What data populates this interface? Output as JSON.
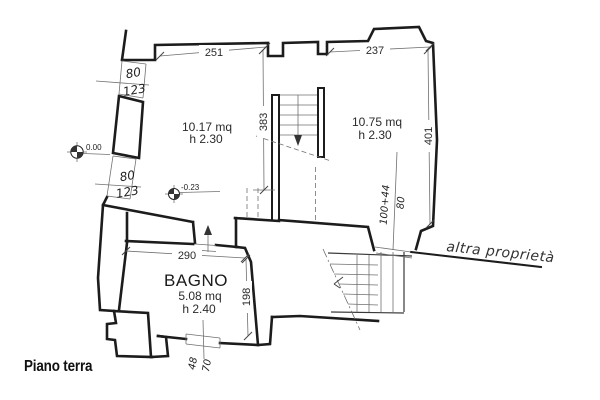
{
  "colors": {
    "ink": "#1c1c1c",
    "thin": "#707070",
    "text": "#2b2b2b"
  },
  "labels": {
    "floor_title": "Piano terra",
    "adjacent_property": "altra proprietà"
  },
  "rooms": {
    "left": {
      "area": "10.17 mq",
      "height": "h 2.30"
    },
    "right": {
      "area": "10.75 mq",
      "height": "h 2.30"
    },
    "bathroom": {
      "name": "BAGNO",
      "area": "5.08 mq",
      "height": "h 2.40"
    }
  },
  "dimensions": {
    "top_left": "251",
    "top_right": "237",
    "stairwell_depth": "383",
    "right_side": "401",
    "bathroom_width": "290",
    "bathroom_depth": "198"
  },
  "openings": {
    "upper_left_window": {
      "width": "80",
      "sill": "123"
    },
    "lower_left_window": {
      "width": "80",
      "sill": "123"
    },
    "bathroom_window": {
      "width": "48",
      "sill": "70"
    },
    "right_door": {
      "height": "100+44",
      "width": "80"
    }
  },
  "levels": {
    "ground": "0.00",
    "offset": "-0.23"
  }
}
